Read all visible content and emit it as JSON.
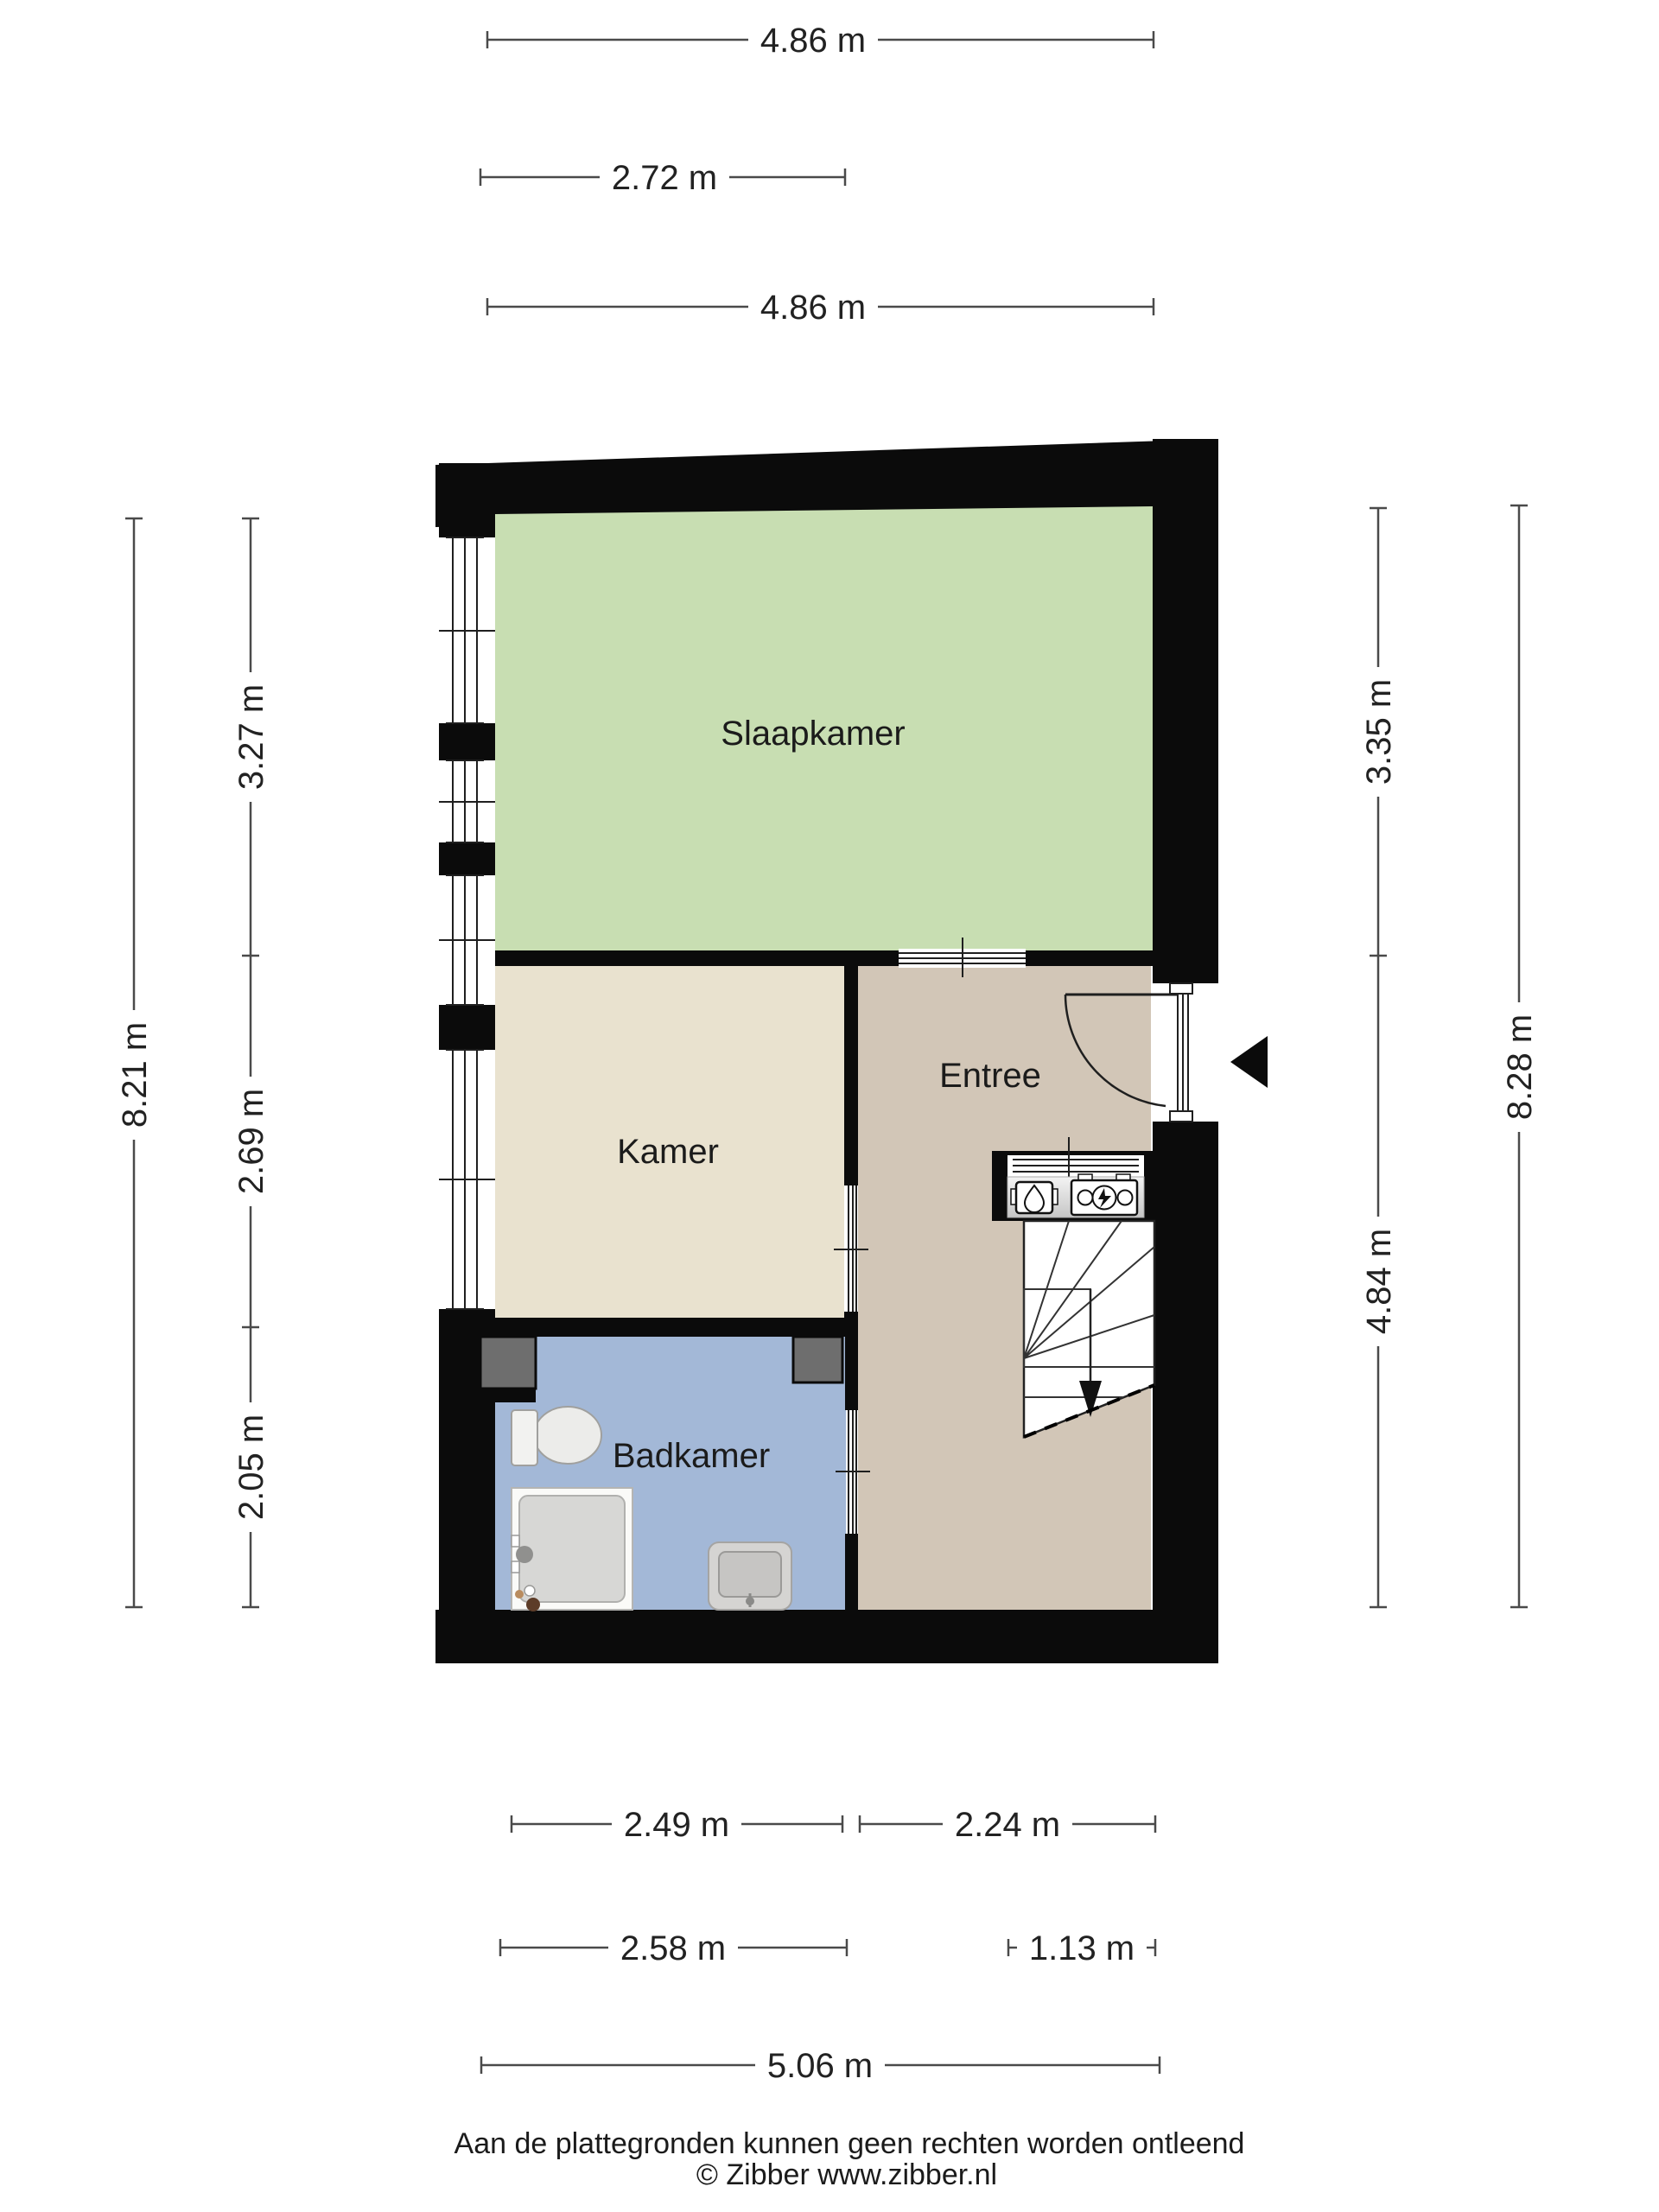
{
  "floorplan": {
    "rooms": [
      {
        "id": "slaapkamer",
        "label": "Slaapkamer",
        "color": "#c8deb2"
      },
      {
        "id": "kamer",
        "label": "Kamer",
        "color": "#e9e2cf"
      },
      {
        "id": "entree",
        "label": "Entree",
        "color": "#d2c6b7"
      },
      {
        "id": "badkamer",
        "label": "Badkamer",
        "color": "#a3b8d7"
      }
    ],
    "wall_color": "#0b0b0b",
    "duct_color": "#6e6e6e",
    "icons": [
      "entrance-arrow-icon",
      "stairs-down-arrow-icon",
      "gas-meter-icon",
      "electricity-meter-icon",
      "toilet-icon",
      "shower-icon",
      "sink-icon",
      "door-swing-icon",
      "window-icon"
    ]
  },
  "dimensions": {
    "top": [
      "4.86 m",
      "2.72 m",
      "4.86 m"
    ],
    "left": {
      "outer": "8.21 m",
      "segments": [
        "3.27 m",
        "2.69 m",
        "2.05 m"
      ]
    },
    "right": {
      "outer": "8.28 m",
      "segments": [
        "3.35 m",
        "4.84 m"
      ]
    },
    "bottom": {
      "row1": [
        "2.49 m",
        "2.24 m"
      ],
      "row2": [
        "2.58 m",
        "1.13 m"
      ],
      "row3": [
        "5.06 m"
      ]
    }
  },
  "footer": {
    "disclaimer": "Aan de plattegronden kunnen geen rechten worden ontleend",
    "copyright": "© Zibber www.zibber.nl"
  }
}
